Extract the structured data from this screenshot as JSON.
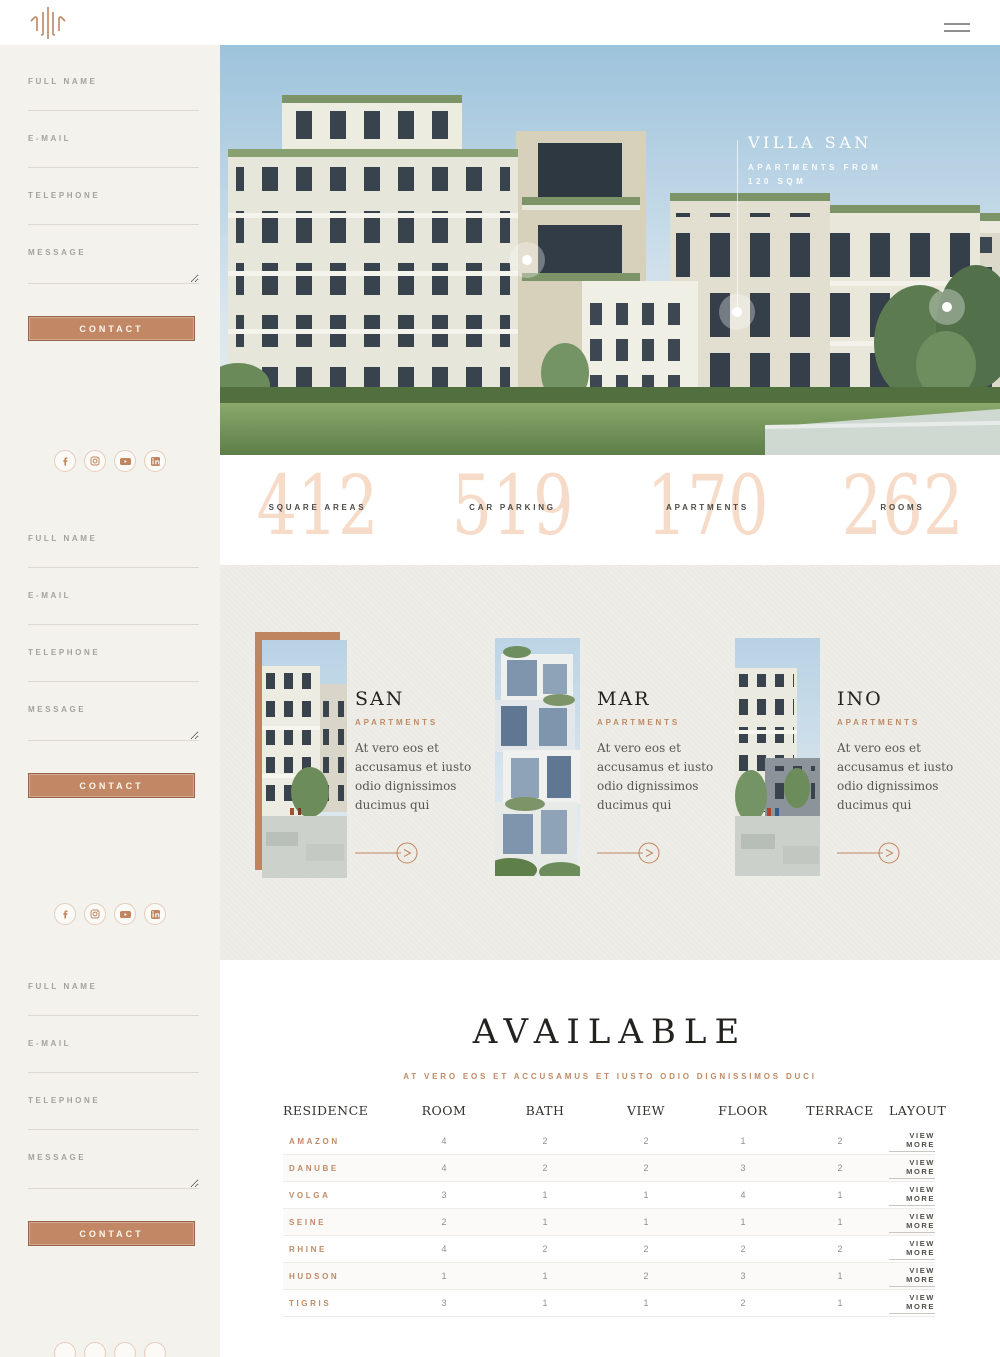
{
  "brand": {
    "logo_icon": "villa-logo-icon"
  },
  "nav": {
    "menu_icon": "hamburger-icon"
  },
  "contact_form": {
    "fields": [
      "FULL NAME",
      "E-MAIL",
      "TELEPHONE",
      "MESSAGE"
    ],
    "submit_label": "CONTACT"
  },
  "social": {
    "icons": [
      "facebook-icon",
      "instagram-icon",
      "youtube-icon",
      "linkedin-icon"
    ]
  },
  "hero": {
    "title": "VILLA SAN",
    "subtitle_line1": "APARTMENTS FROM",
    "subtitle_line2": "120 SQM"
  },
  "stats": [
    {
      "value": "412",
      "label": "SQUARE AREAS"
    },
    {
      "value": "519",
      "label": "CAR PARKING"
    },
    {
      "value": "170",
      "label": "APARTMENTS"
    },
    {
      "value": "262",
      "label": "ROOMS"
    }
  ],
  "cards": [
    {
      "title": "SAN",
      "tag": "APARTMENTS",
      "body": "At vero eos et accusamus et iusto odio dignissimos ducimus qui"
    },
    {
      "title": "MAR",
      "tag": "APARTMENTS",
      "body": "At vero eos et accusamus et iusto odio dignissimos ducimus qui"
    },
    {
      "title": "INO",
      "tag": "APARTMENTS",
      "body": "At vero eos et accusamus et iusto odio dignissimos ducimus qui"
    }
  ],
  "available": {
    "title": "AVAILABLE",
    "subtitle": "AT VERO EOS ET ACCUSAMUS ET IUSTO ODIO DIGNISSIMOS DUCI",
    "columns": [
      "RESIDENCE",
      "ROOM",
      "BATH",
      "VIEW",
      "FLOOR",
      "TERRACE",
      "LAYOUT"
    ],
    "view_more_label": "VIEW MORE",
    "rows": [
      {
        "residence": "AMAZON",
        "room": "4",
        "bath": "2",
        "view": "2",
        "floor": "1",
        "terrace": "2"
      },
      {
        "residence": "DANUBE",
        "room": "4",
        "bath": "2",
        "view": "2",
        "floor": "3",
        "terrace": "2"
      },
      {
        "residence": "VOLGA",
        "room": "3",
        "bath": "1",
        "view": "1",
        "floor": "4",
        "terrace": "1"
      },
      {
        "residence": "SEINE",
        "room": "2",
        "bath": "1",
        "view": "1",
        "floor": "1",
        "terrace": "1"
      },
      {
        "residence": "RHINE",
        "room": "4",
        "bath": "2",
        "view": "2",
        "floor": "2",
        "terrace": "2"
      },
      {
        "residence": "HUDSON",
        "room": "1",
        "bath": "1",
        "view": "2",
        "floor": "3",
        "terrace": "1"
      },
      {
        "residence": "TIGRIS",
        "room": "3",
        "bath": "1",
        "view": "1",
        "floor": "2",
        "terrace": "1"
      }
    ]
  },
  "colors": {
    "accent": "#c08a65",
    "stat_number": "#f6dcc8",
    "sidebar_bg": "#f4f2ed",
    "cards_bg": "#efede7"
  }
}
